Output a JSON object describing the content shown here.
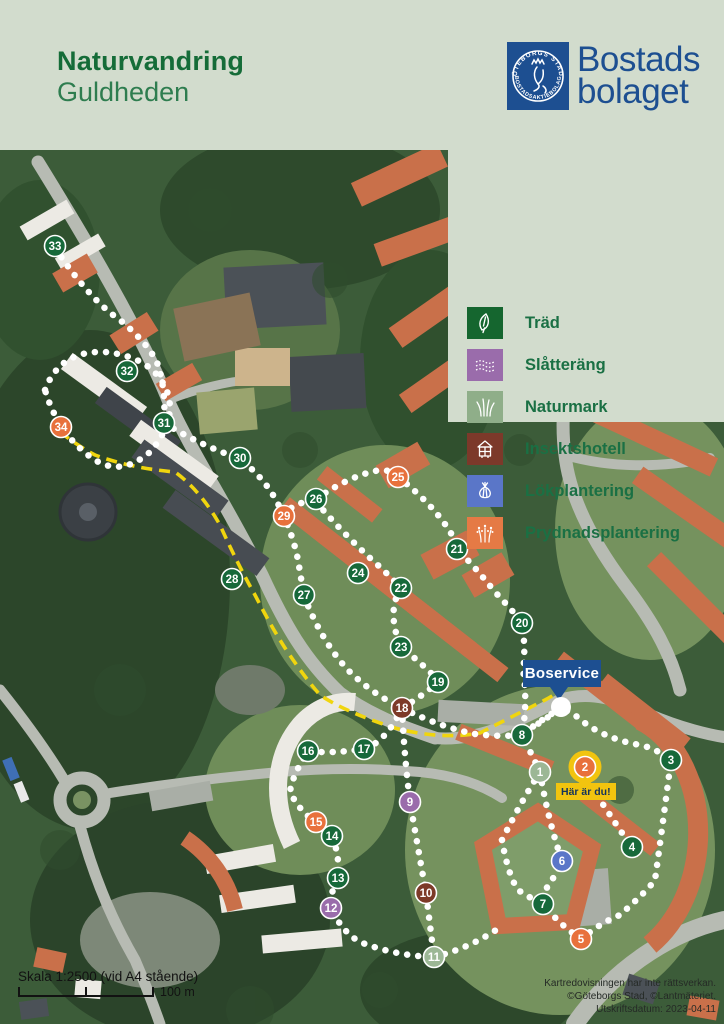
{
  "header": {
    "title": "Naturvandring",
    "subtitle": "Guldheden",
    "logo": {
      "seal_text_top": "GÖTEBORGS STADS",
      "seal_text_bottom": "BOSTADSAKTIEBOLAG",
      "wordmark_line1": "Bostads",
      "wordmark_line2": "bolaget"
    }
  },
  "legend": {
    "items": [
      {
        "label": "Träd",
        "type": "trad",
        "color": "#15662f",
        "icon": "leaf-icon"
      },
      {
        "label": "Slåtteräng",
        "type": "slatterang",
        "color": "#9a6cab",
        "icon": "meadow-icon"
      },
      {
        "label": "Naturmark",
        "type": "naturmark",
        "color": "#8fae89",
        "icon": "grass-icon"
      },
      {
        "label": "Insektshotell",
        "type": "insektshotell",
        "color": "#7c392a",
        "icon": "insect-hotel-icon"
      },
      {
        "label": "Lökplantering",
        "type": "lokplantering",
        "color": "#5a76c8",
        "icon": "onion-icon"
      },
      {
        "label": "Prydnadsplantering",
        "type": "prydnadsplantering",
        "color": "#e57a45",
        "icon": "ornamental-icon"
      }
    ]
  },
  "map": {
    "boservice_label": "Boservice",
    "you_are_here_label": "Här är du!",
    "you_are_here_ring_color": "#f2c40f",
    "marker_colors": {
      "trad": "#17693a",
      "slatterang": "#9a6cab",
      "naturmark": "#9cb795",
      "insektshotell": "#7d3a28",
      "lokplantering": "#5a76c8",
      "prydnadsplantering": "#e8713c"
    },
    "markers": [
      {
        "n": 1,
        "type": "naturmark",
        "x": 540,
        "y": 622
      },
      {
        "n": 2,
        "type": "prydnadsplantering",
        "x": 585,
        "y": 617,
        "ring": true
      },
      {
        "n": 3,
        "type": "trad",
        "x": 671,
        "y": 610
      },
      {
        "n": 4,
        "type": "trad",
        "x": 632,
        "y": 697
      },
      {
        "n": 5,
        "type": "prydnadsplantering",
        "x": 581,
        "y": 789
      },
      {
        "n": 6,
        "type": "lokplantering",
        "x": 562,
        "y": 711
      },
      {
        "n": 7,
        "type": "trad",
        "x": 543,
        "y": 754
      },
      {
        "n": 8,
        "type": "trad",
        "x": 522,
        "y": 585
      },
      {
        "n": 9,
        "type": "slatterang",
        "x": 410,
        "y": 652
      },
      {
        "n": 10,
        "type": "insektshotell",
        "x": 426,
        "y": 743
      },
      {
        "n": 11,
        "type": "naturmark",
        "x": 434,
        "y": 807
      },
      {
        "n": 12,
        "type": "slatterang",
        "x": 331,
        "y": 758
      },
      {
        "n": 13,
        "type": "trad",
        "x": 338,
        "y": 728
      },
      {
        "n": 14,
        "type": "trad",
        "x": 332,
        "y": 686
      },
      {
        "n": 15,
        "type": "prydnadsplantering",
        "x": 316,
        "y": 672
      },
      {
        "n": 16,
        "type": "trad",
        "x": 308,
        "y": 601
      },
      {
        "n": 17,
        "type": "trad",
        "x": 364,
        "y": 599
      },
      {
        "n": 18,
        "type": "insektshotell",
        "x": 402,
        "y": 558
      },
      {
        "n": 19,
        "type": "trad",
        "x": 438,
        "y": 532
      },
      {
        "n": 20,
        "type": "trad",
        "x": 522,
        "y": 473
      },
      {
        "n": 21,
        "type": "trad",
        "x": 457,
        "y": 399
      },
      {
        "n": 22,
        "type": "trad",
        "x": 401,
        "y": 438
      },
      {
        "n": 23,
        "type": "trad",
        "x": 401,
        "y": 497
      },
      {
        "n": 24,
        "type": "trad",
        "x": 358,
        "y": 423
      },
      {
        "n": 25,
        "type": "prydnadsplantering",
        "x": 398,
        "y": 327
      },
      {
        "n": 26,
        "type": "trad",
        "x": 316,
        "y": 349
      },
      {
        "n": 27,
        "type": "trad",
        "x": 304,
        "y": 445
      },
      {
        "n": 28,
        "type": "trad",
        "x": 232,
        "y": 429
      },
      {
        "n": 29,
        "type": "prydnadsplantering",
        "x": 284,
        "y": 366
      },
      {
        "n": 30,
        "type": "trad",
        "x": 240,
        "y": 308
      },
      {
        "n": 31,
        "type": "trad",
        "x": 164,
        "y": 273
      },
      {
        "n": 32,
        "type": "trad",
        "x": 127,
        "y": 221
      },
      {
        "n": 33,
        "type": "trad",
        "x": 55,
        "y": 96
      },
      {
        "n": 34,
        "type": "prydnadsplantering",
        "x": 61,
        "y": 277
      }
    ]
  },
  "scale": {
    "label": "Skala 1:2500 (vid A4 stående)",
    "distance": "100 m"
  },
  "attribution": {
    "line1": "Kartredovisningen har inte rättsverkan.",
    "line2": "©Göteborgs Stad, ©Lantmäteriet.",
    "line3": "Utskriftsdatum: 2023-04-11"
  }
}
